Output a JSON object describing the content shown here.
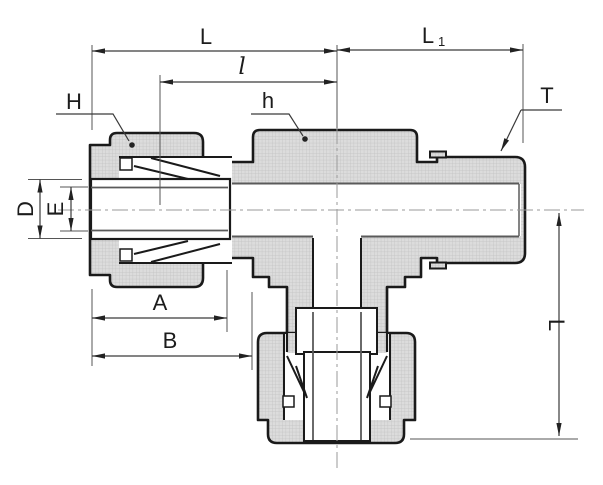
{
  "drawing": {
    "description": "Engineering dimensional drawing of a compression tube tee fitting with male threaded end",
    "labels": {
      "L_top": "L",
      "L1_main": "L",
      "L1_sub": "1",
      "l_small": "l",
      "H": "H",
      "h": "h",
      "T": "T",
      "D": "D",
      "E": "E",
      "A": "A",
      "B": "B",
      "L_right": "L"
    },
    "colors": {
      "outline": "#1a1a1a",
      "hatch_fill": "#dcdcdc",
      "hatch_line": "#c3c3c3",
      "dim_line": "#3a3a3a",
      "extension_line": "#555555",
      "centerline": "#9a9a9a",
      "bore_line": "#5a5a5a",
      "background": "#ffffff"
    }
  }
}
